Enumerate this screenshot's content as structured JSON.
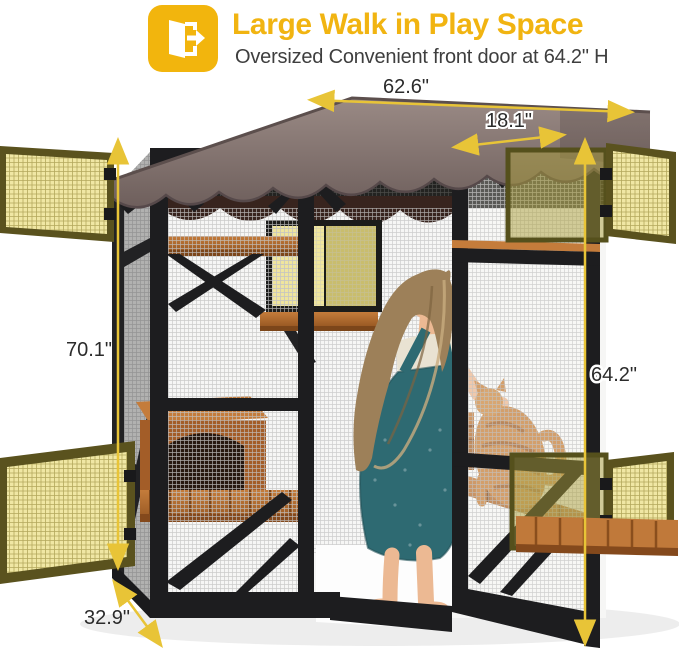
{
  "header": {
    "icon_name": "door-exit-icon",
    "title": "Large Walk in Play Space",
    "subtitle": "Oversized Convenient front door at 64.2\" H"
  },
  "dimensions": {
    "top_width": "62.6\"",
    "door_width": "18.1\"",
    "left_height": "70.1\"",
    "door_height": "64.2\"",
    "depth": "32.9\""
  },
  "colors": {
    "accent_yellow": "#f2b50d",
    "dimension_yellow": "#e8c437",
    "label_dark": "#2b2b2b",
    "roof_brown": "#8a7a77",
    "frame_black": "#1d1d1f",
    "wood_orange": "#b06a31",
    "panel_mesh_yellow": "#efe6a2"
  }
}
